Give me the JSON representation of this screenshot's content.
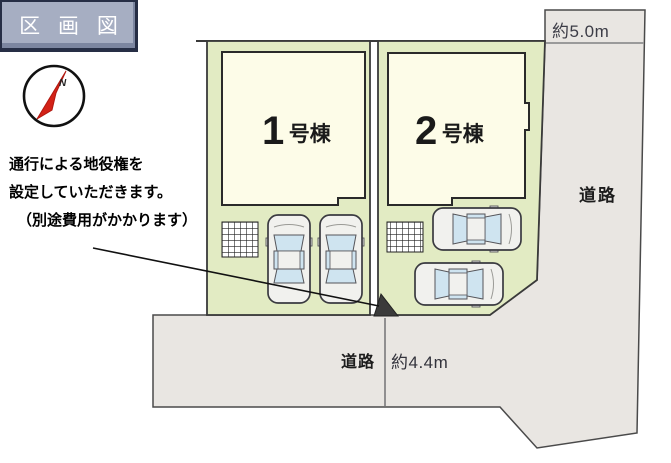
{
  "title_banner": {
    "label": "区 画 図"
  },
  "compass": {
    "label": "N"
  },
  "annotation": {
    "line1": "通行による地役権を",
    "line2": "設定していただきます。",
    "line3": "（別途費用がかかります）"
  },
  "plots": {
    "building1": {
      "number": "1",
      "suffix": "号棟"
    },
    "building2": {
      "number": "2",
      "suffix": "号棟"
    }
  },
  "roads": {
    "right": {
      "label": "道路",
      "width_label": "約5.0m"
    },
    "bottom": {
      "label": "道路",
      "width_label": "約4.4m"
    }
  },
  "colors": {
    "plot_green": "#e2ebc3",
    "building_cream": "#fdfce8",
    "road_gray": "#e9e6e2",
    "banner_fill": "#a6aec2",
    "banner_border": "#262e45",
    "compass_red": "#d32217",
    "car_body": "#f1f1ee",
    "car_window": "#cfe4f0",
    "easement_dark": "#3b3b3b",
    "line_dark": "#2a2a2a"
  }
}
